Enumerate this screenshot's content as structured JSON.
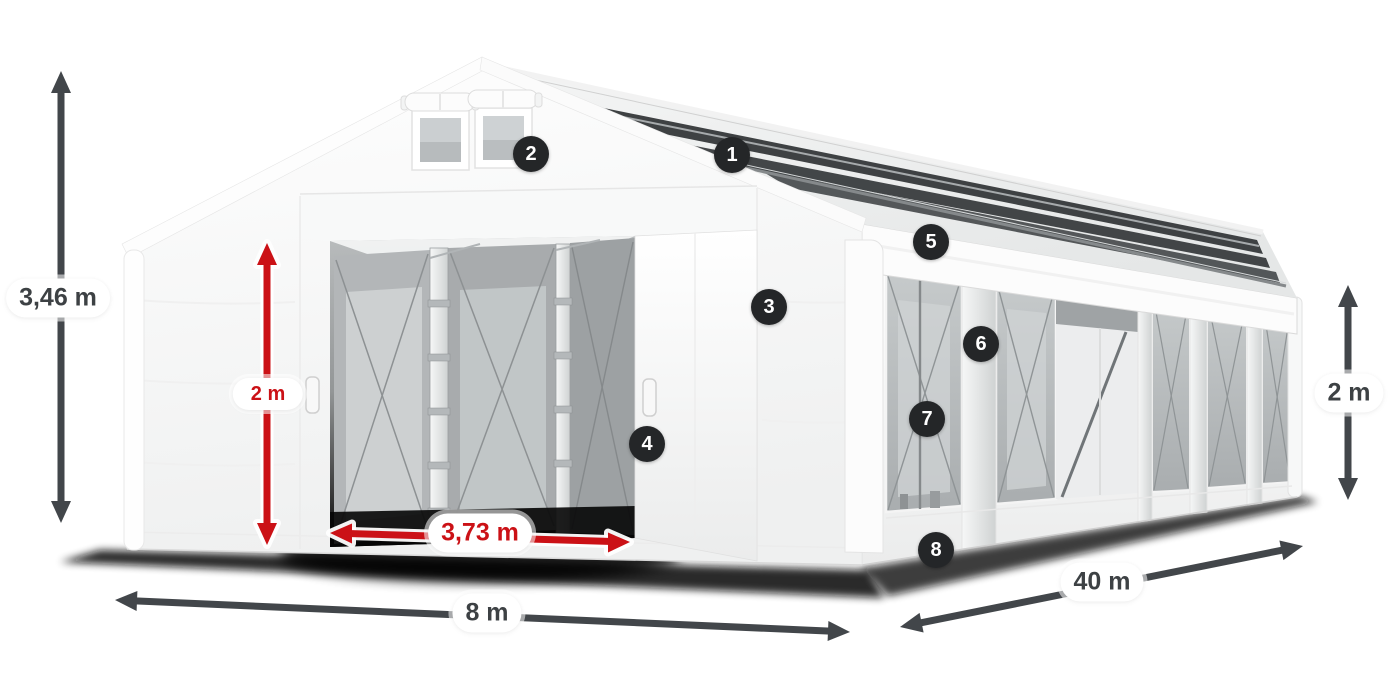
{
  "colors": {
    "bg": "#ffffff",
    "arrow": "#42464a",
    "red": "#cb1116",
    "badge-bg": "#242628",
    "badge-text": "#ffffff",
    "pill-bg": "#ffffff",
    "pill-text": "#3d4144",
    "tent-white": "#f8f9f9",
    "mesh-gray": "#b6babc",
    "skylight-dark": "#3e4143"
  },
  "dimensions": {
    "total_height": "3,46 m",
    "door_height": "2 m",
    "door_width": "3,73 m",
    "front_width": "8 m",
    "side_length": "40 m",
    "side_wall_height": "2 m"
  },
  "callouts": [
    "1",
    "2",
    "3",
    "4",
    "5",
    "6",
    "7",
    "8"
  ]
}
